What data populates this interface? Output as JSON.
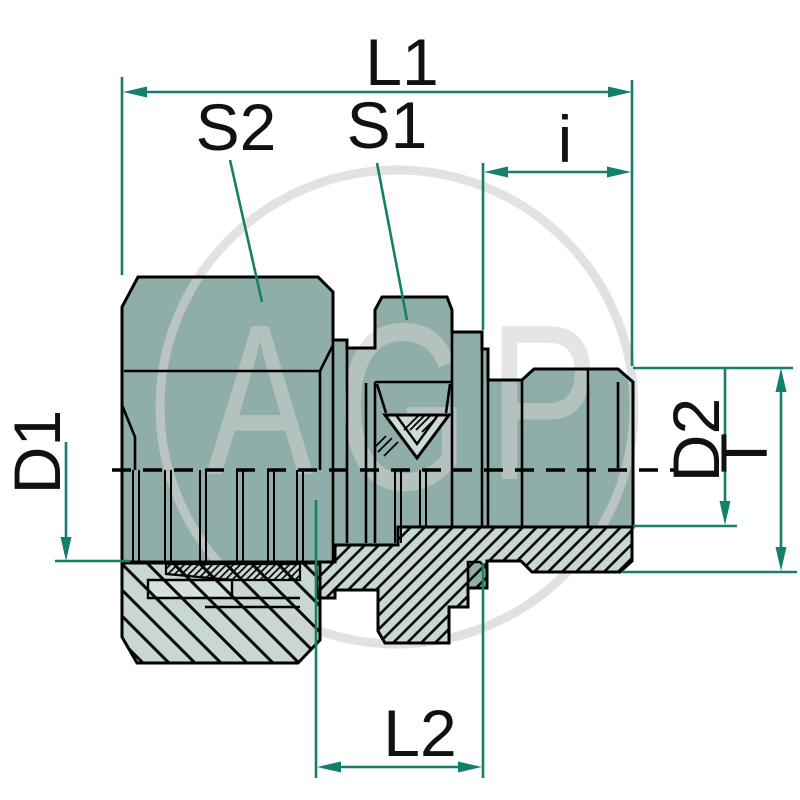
{
  "drawing": {
    "title": "hydraulic straight male stud fitting - dimensioned section drawing",
    "watermark": {
      "letters": {
        "a": "A",
        "g": "G",
        "p": "P"
      }
    },
    "dimensions": {
      "l1": "L1",
      "s2": "S2",
      "s1": "S1",
      "i": "i",
      "d1": "D1",
      "d2": "D2",
      "t": "T",
      "l2": "L2"
    },
    "colors": {
      "body": "#8fada9",
      "section": "#c9d7d1",
      "tube": "#d7e1dc",
      "cone": "#cfdcd6",
      "dimension": "#15806a",
      "watermark": "#d2d2d2",
      "outline": "#000000"
    }
  }
}
